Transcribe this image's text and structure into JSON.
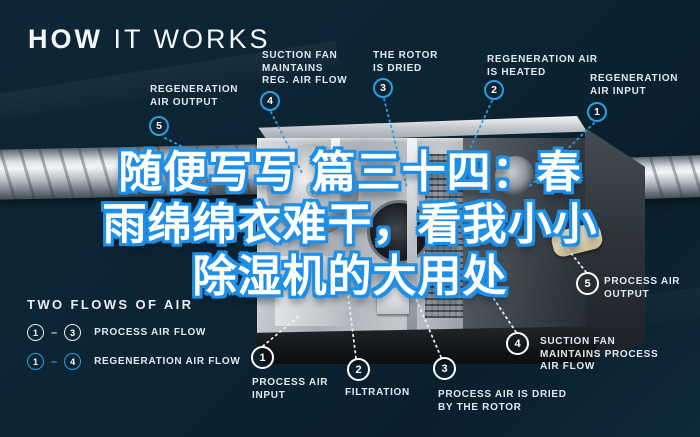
{
  "title": {
    "bold": "HOW",
    "light": "IT WORKS"
  },
  "overlay": {
    "lines": [
      "随便写写 篇三十四：春",
      "雨绵绵衣难干，看我小小",
      "除湿机的大用处"
    ]
  },
  "callouts": {
    "top": [
      {
        "num": "5",
        "lines": [
          "REGENERATION",
          "AIR OUTPUT"
        ]
      },
      {
        "num": "4",
        "lines": [
          "SUCTION FAN",
          "MAINTAINS",
          "REG. AIR FLOW"
        ]
      },
      {
        "num": "3",
        "lines": [
          "THE ROTOR",
          "IS DRIED"
        ]
      },
      {
        "num": "2",
        "lines": [
          "REGENERATION AIR",
          "IS HEATED"
        ]
      },
      {
        "num": "1",
        "lines": [
          "REGENERATION",
          "AIR INPUT"
        ]
      }
    ],
    "bottom": [
      {
        "num": "1",
        "lines": [
          "PROCESS AIR",
          "INPUT"
        ]
      },
      {
        "num": "2",
        "lines": [
          "FILTRATION"
        ]
      },
      {
        "num": "3",
        "lines": [
          "PROCESS AIR IS DRIED",
          "BY THE ROTOR"
        ]
      },
      {
        "num": "4",
        "lines": [
          "SUCTION FAN",
          "MAINTAINS PROCESS",
          "AIR FLOW"
        ]
      },
      {
        "num": "5",
        "lines": [
          "PROCESS AIR",
          "OUTPUT"
        ]
      }
    ]
  },
  "legend": {
    "title": "TWO FLOWS OF AIR",
    "rows": [
      {
        "from": "1",
        "sep": "–",
        "to": "3",
        "label": "PROCESS AIR FLOW",
        "color": "white"
      },
      {
        "from": "1",
        "sep": "–",
        "to": "4",
        "label": "REGENERATION AIR FLOW",
        "color": "blue"
      }
    ]
  },
  "colors": {
    "background": "#0d2433",
    "accent_blue": "#2b9fe0",
    "label_text": "#dfe8ee",
    "overlay_fill": "#ffffff",
    "overlay_stroke": "#1d8fe8"
  }
}
